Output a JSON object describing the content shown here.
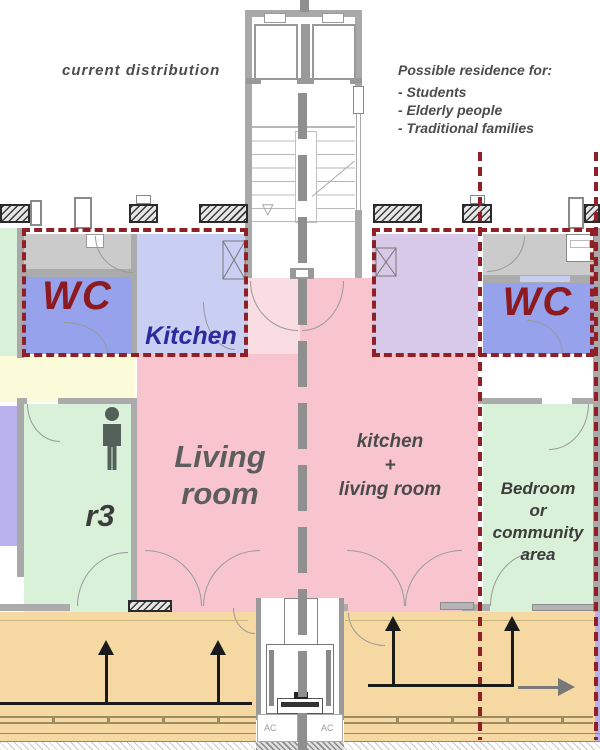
{
  "annotations": {
    "left_title": "current distribution",
    "right_title": "Possible residence for:",
    "residence_options": [
      "- Students",
      "- Elderly people",
      "- Traditional families"
    ]
  },
  "rooms": {
    "wc_left": "WC",
    "kitchen": "Kitchen",
    "living_room": "Living\nroom",
    "kitchen_living": "kitchen\n+\nliving room",
    "wc_right": "WC",
    "r3": "r3",
    "bedroom": "Bedroom\nor\ncommunity\narea"
  },
  "equipment": {
    "ac_left": "AC",
    "ac_right": "AC"
  },
  "colors": {
    "wc_blue": "#97a2ec",
    "kitchen_blue": "#c9cef3",
    "lavender": "#d9c9e9",
    "pink": "#f8c5ce",
    "pale_pink": "#fadde3",
    "room_green": "#d9f0d9",
    "corridor_orange": "#f6d9a2",
    "corridor_yellow": "#fbfad9",
    "periwinkle": "#b9b1ee",
    "unit_dash_red": "#8f2026",
    "wall_gray": "#a9a9a9",
    "hallway_gray": "#cbcbcb",
    "section_line_gray": "#8f8f8f"
  }
}
